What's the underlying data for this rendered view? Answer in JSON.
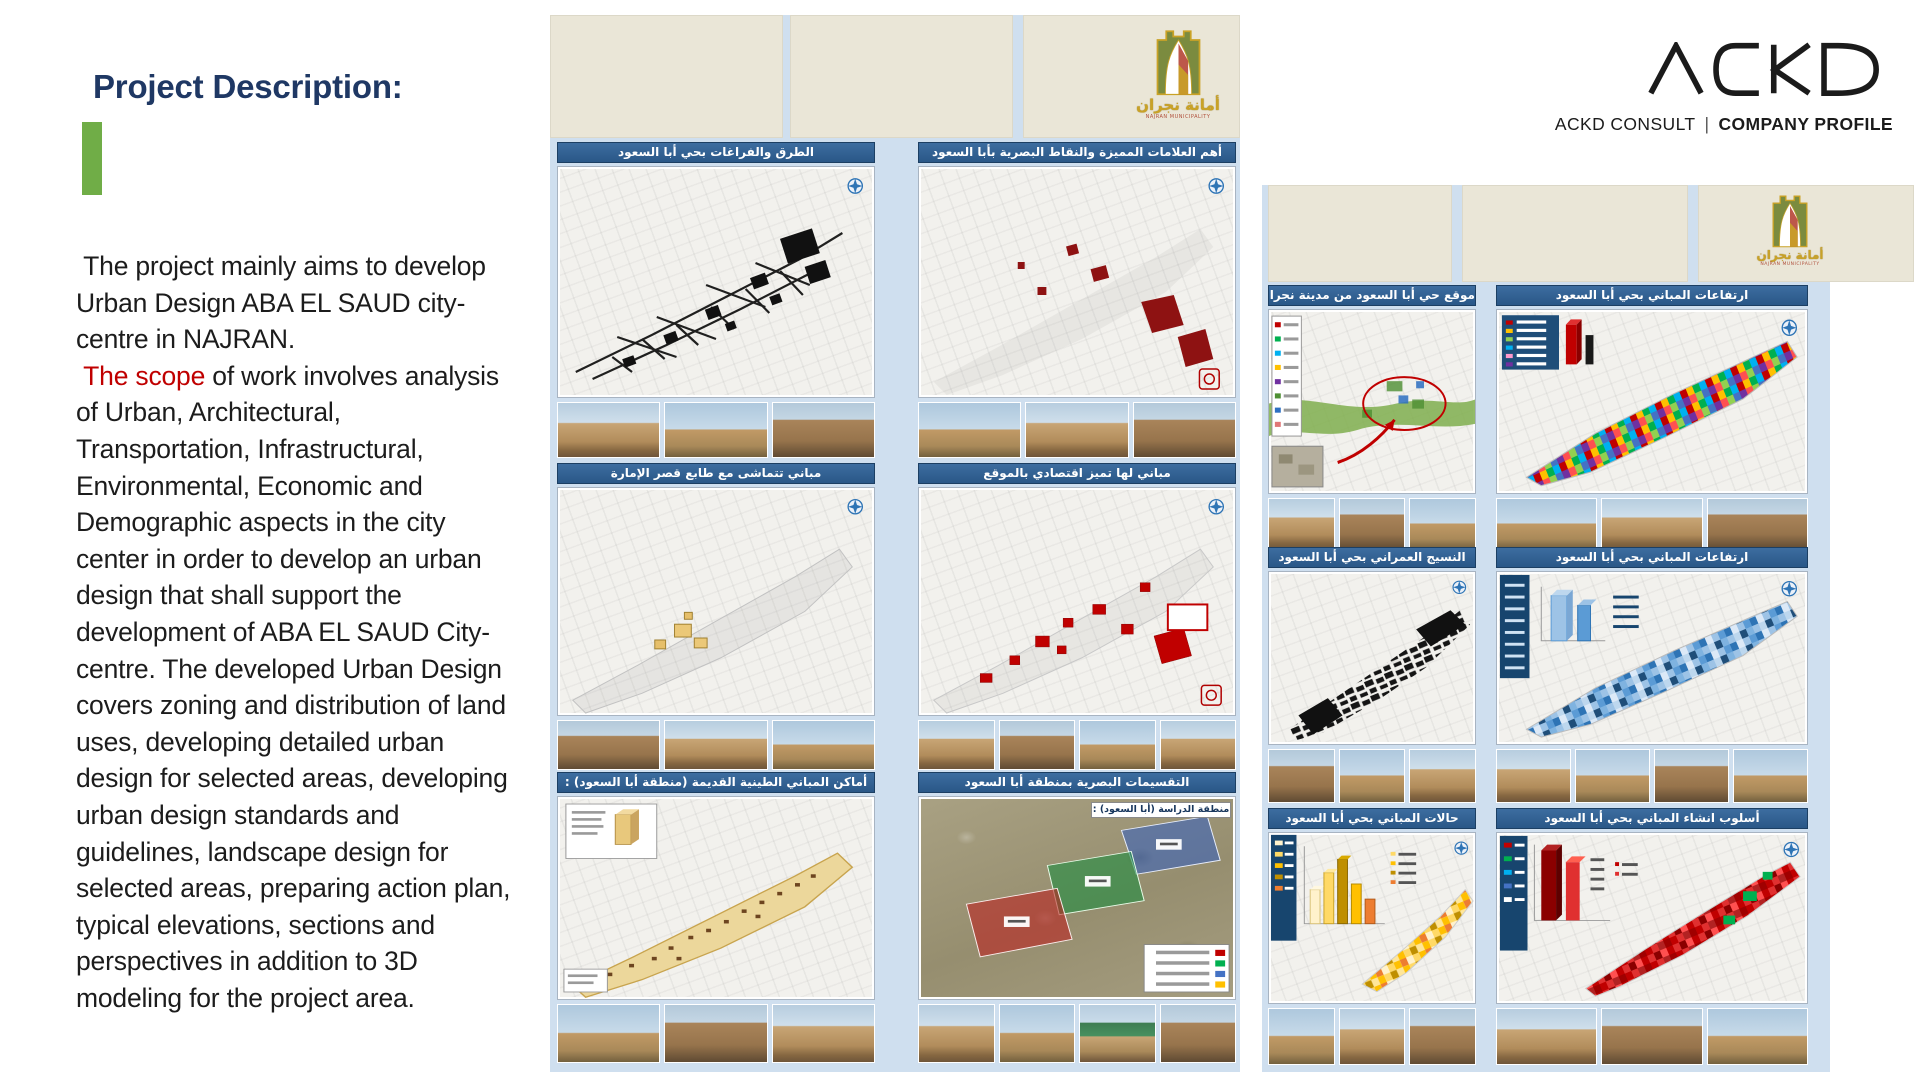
{
  "left": {
    "title": "Project Description:",
    "para1": " The project mainly aims to develop\nUrban Design ABA EL SAUD city-\ncentre in NAJRAN.\n ",
    "scope": "The scope",
    "para2": " of work involves analysis\nof Urban, Architectural,\nTransportation, Infrastructural,\nEnvironmental, Economic and\nDemographic aspects in the city\ncenter in order to develop an urban\ndesign that shall support the\ndevelopment of ABA EL SAUD City-\ncentre. The developed Urban Design\ncovers zoning and distribution of land\nuses, developing detailed urban\ndesign for selected areas, developing\nurban design standards and\nguidelines, landscape design for\nselected areas, preparing action plan,\ntypical elevations, sections and\nperspectives in addition to 3D\nmodeling for the project area."
  },
  "brand": {
    "logo_text": "ACKD",
    "subtitle_left": "ACKD CONSULT",
    "subtitle_sep": "|",
    "subtitle_right": "COMPANY PROFILE"
  },
  "municipality": {
    "name_ar": "أمانة نجران",
    "name_en": "NAJRAN MUNICIPALITY"
  },
  "poster_center": {
    "panels": [
      {
        "title": "الطرق والفراغات بحي أبا السعود"
      },
      {
        "title": "أهم العلامات المميزة والنقاط البصرية بأبا السعود"
      },
      {
        "title": "مباني تتماشى مع طابع قصر الإمارة"
      },
      {
        "title": "مباني لها تميز اقتصادي بالموقع"
      },
      {
        "title": "أماكن المباني الطينية القديمة (منطقة أبا السعود) :"
      },
      {
        "title": "التقسيمات البصرية بمنطقة أبا السعود"
      }
    ],
    "study_area_label": "منطقة الدراسة (أبا السعود) :"
  },
  "poster_right": {
    "panels": [
      {
        "title": "موقع حي أبا السعود من مدينة نجران"
      },
      {
        "title": "ارتفاعات المباني بحي أبا السعود"
      },
      {
        "title": "النسيج العمراني بحي أبا السعود"
      },
      {
        "title": "ارتفاعات المباني بحي أبا السعود"
      },
      {
        "title": "حالات المباني بحي أبا السعود"
      },
      {
        "title": "أسلوب انشاء المباني بحي أبا السعود"
      }
    ]
  },
  "colors": {
    "title_navy": "#1F3864",
    "accent_green": "#70AD47",
    "scope_red": "#C00000",
    "header_blue": "#2E6093",
    "poster_bg_blue": "#CFDFEF",
    "band_beige": "#EAE6D7",
    "legend_navy": "#17456E"
  }
}
